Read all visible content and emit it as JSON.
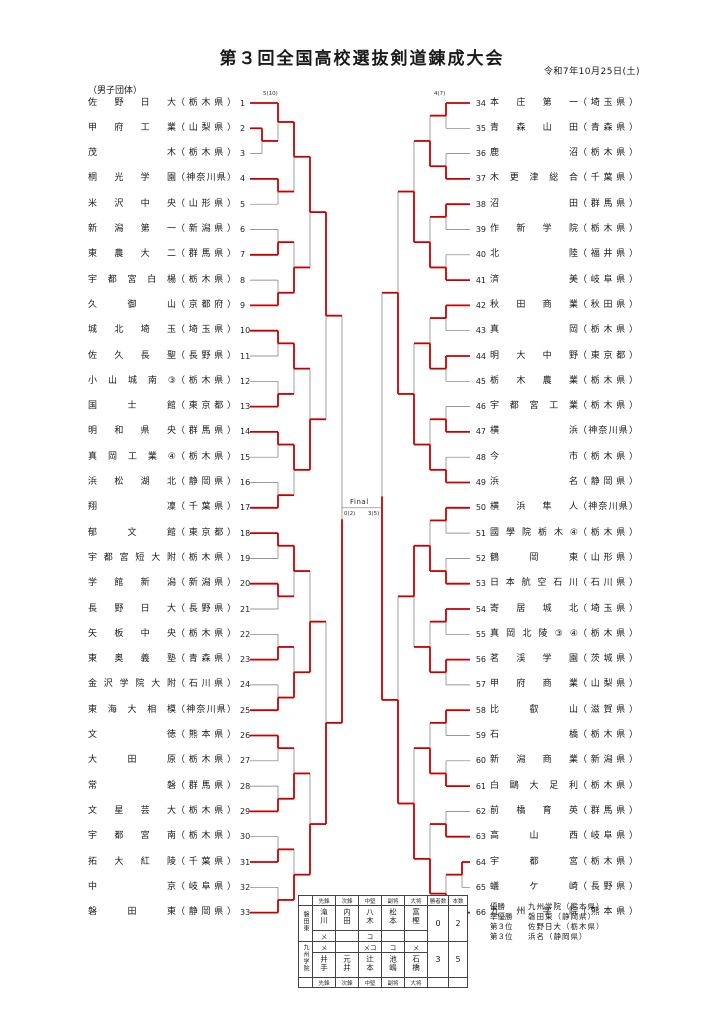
{
  "page": {
    "title": "第３回全国高校選抜剣道錬成大会",
    "date": "令和7年10月25日(土)",
    "category": "（男子団体）"
  },
  "teams": [
    {
      "n": 1,
      "name": "佐野日大",
      "pref": "栃木県"
    },
    {
      "n": 2,
      "name": "甲府工業",
      "pref": "山梨県"
    },
    {
      "n": 3,
      "name": "茂木",
      "pref": "栃木県"
    },
    {
      "n": 4,
      "name": "桐光学園",
      "pref": "神奈川県"
    },
    {
      "n": 5,
      "name": "米沢中央",
      "pref": "山形県"
    },
    {
      "n": 6,
      "name": "新潟第一",
      "pref": "新潟県"
    },
    {
      "n": 7,
      "name": "東農大二",
      "pref": "群馬県"
    },
    {
      "n": 8,
      "name": "宇都宮白楊",
      "pref": "栃木県"
    },
    {
      "n": 9,
      "name": "久御山",
      "pref": "京都府"
    },
    {
      "n": 10,
      "name": "城北埼玉",
      "pref": "埼玉県"
    },
    {
      "n": 11,
      "name": "佐久長聖",
      "pref": "長野県"
    },
    {
      "n": 12,
      "name": "小山城南",
      "mark": "③",
      "pref": "栃木県"
    },
    {
      "n": 13,
      "name": "国士館",
      "pref": "東京都"
    },
    {
      "n": 14,
      "name": "明和県央",
      "pref": "群馬県"
    },
    {
      "n": 15,
      "name": "真岡工業",
      "mark": "④",
      "pref": "栃木県"
    },
    {
      "n": 16,
      "name": "浜松湖北",
      "pref": "静岡県"
    },
    {
      "n": 17,
      "name": "翔凜",
      "pref": "千葉県"
    },
    {
      "n": 18,
      "name": "郁文館",
      "pref": "東京都"
    },
    {
      "n": 19,
      "name": "宇都宮短大附",
      "pref": "栃木県"
    },
    {
      "n": 20,
      "name": "学館新潟",
      "pref": "新潟県"
    },
    {
      "n": 21,
      "name": "長野日大",
      "pref": "長野県"
    },
    {
      "n": 22,
      "name": "矢板中央",
      "pref": "栃木県"
    },
    {
      "n": 23,
      "name": "東奥義塾",
      "pref": "青森県"
    },
    {
      "n": 24,
      "name": "金沢学院大附",
      "pref": "石川県"
    },
    {
      "n": 25,
      "name": "東海大相模",
      "pref": "神奈川県"
    },
    {
      "n": 26,
      "name": "文徳",
      "pref": "熊本県"
    },
    {
      "n": 27,
      "name": "大田原",
      "pref": "栃木県"
    },
    {
      "n": 28,
      "name": "常磐",
      "pref": "群馬県"
    },
    {
      "n": 29,
      "name": "文星芸大",
      "pref": "栃木県"
    },
    {
      "n": 30,
      "name": "宇都宮南",
      "pref": "栃木県"
    },
    {
      "n": 31,
      "name": "拓大紅陵",
      "pref": "千葉県"
    },
    {
      "n": 32,
      "name": "中京",
      "pref": "岐阜県"
    },
    {
      "n": 33,
      "name": "磐田東",
      "pref": "静岡県"
    },
    {
      "n": 34,
      "name": "本庄第一",
      "pref": "埼玉県"
    },
    {
      "n": 35,
      "name": "青森山田",
      "pref": "青森県"
    },
    {
      "n": 36,
      "name": "鹿沼",
      "pref": "栃木県"
    },
    {
      "n": 37,
      "name": "木更津総合",
      "pref": "千葉県"
    },
    {
      "n": 38,
      "name": "沼田",
      "pref": "群馬県"
    },
    {
      "n": 39,
      "name": "作新学院",
      "pref": "栃木県"
    },
    {
      "n": 40,
      "name": "北陸",
      "pref": "福井県"
    },
    {
      "n": 41,
      "name": "済美",
      "pref": "岐阜県"
    },
    {
      "n": 42,
      "name": "秋田商業",
      "pref": "秋田県"
    },
    {
      "n": 43,
      "name": "真岡",
      "pref": "栃木県"
    },
    {
      "n": 44,
      "name": "明大中野",
      "pref": "東京都"
    },
    {
      "n": 45,
      "name": "栃木農業",
      "pref": "栃木県"
    },
    {
      "n": 46,
      "name": "宇都宮工業",
      "pref": "栃木県"
    },
    {
      "n": 47,
      "name": "横浜",
      "pref": "神奈川県"
    },
    {
      "n": 48,
      "name": "今市",
      "pref": "栃木県"
    },
    {
      "n": 49,
      "name": "浜名",
      "pref": "静岡県"
    },
    {
      "n": 50,
      "name": "横浜隼人",
      "pref": "神奈川県"
    },
    {
      "n": 51,
      "name": "國學院栃木",
      "mark": "④",
      "pref": "栃木県"
    },
    {
      "n": 52,
      "name": "鶴岡東",
      "pref": "山形県"
    },
    {
      "n": 53,
      "name": "日本航空石川",
      "pref": "石川県"
    },
    {
      "n": 54,
      "name": "寄居城北",
      "pref": "埼玉県"
    },
    {
      "n": 55,
      "name": "真岡北陵",
      "mark": "③④",
      "pref": "栃木県"
    },
    {
      "n": 56,
      "name": "茗渓学園",
      "pref": "茨城県"
    },
    {
      "n": 57,
      "name": "甲府商業",
      "pref": "山梨県"
    },
    {
      "n": 58,
      "name": "比叡山",
      "pref": "滋賀県"
    },
    {
      "n": 59,
      "name": "石橋",
      "pref": "栃木県"
    },
    {
      "n": 60,
      "name": "新潟商業",
      "pref": "新潟県"
    },
    {
      "n": 61,
      "name": "白鷗大足利",
      "pref": "栃木県"
    },
    {
      "n": 62,
      "name": "前橋育英",
      "pref": "群馬県"
    },
    {
      "n": 63,
      "name": "高山西",
      "pref": "岐阜県"
    },
    {
      "n": 64,
      "name": "宇都宮",
      "pref": "栃木県"
    },
    {
      "n": 65,
      "name": "蟻ケ崎",
      "pref": "長野県"
    },
    {
      "n": 66,
      "name": "九州学院",
      "pref": "熊本県"
    }
  ],
  "bracket": {
    "colors": {
      "win": "#c40000",
      "line": "#777777"
    },
    "final_label": "Final",
    "final_left_score": "0(2)",
    "final_right_score": "3(5)",
    "score_labels": [
      {
        "team": 1,
        "text": "5(10)"
      },
      {
        "team": 34,
        "text": "4(7)"
      }
    ],
    "left": {
      "playin": {
        "a": 2,
        "b": 3,
        "winner": 2
      },
      "slots": [
        [
          1,
          0
        ],
        [
          4,
          5
        ],
        [
          6,
          7
        ],
        [
          8,
          9
        ],
        [
          10,
          11
        ],
        [
          12,
          13
        ],
        [
          14,
          15
        ],
        [
          16,
          17
        ],
        [
          18,
          19
        ],
        [
          20,
          21
        ],
        [
          22,
          23
        ],
        [
          24,
          25
        ],
        [
          26,
          27
        ],
        [
          28,
          29
        ],
        [
          30,
          31
        ],
        [
          32,
          33
        ]
      ],
      "winners": [
        [
          1,
          4,
          7,
          9,
          10,
          13,
          14,
          17,
          18,
          20,
          23,
          25,
          26,
          29,
          31,
          33
        ],
        [
          1,
          9,
          10,
          14,
          18,
          25,
          29,
          33
        ],
        [
          1,
          14,
          25,
          33
        ],
        [
          1,
          33
        ],
        [
          33
        ]
      ]
    },
    "right": {
      "playin": {
        "a": 64,
        "b": 65,
        "winner": 64
      },
      "slots": [
        [
          34,
          35
        ],
        [
          36,
          37
        ],
        [
          38,
          39
        ],
        [
          40,
          41
        ],
        [
          42,
          43
        ],
        [
          44,
          45
        ],
        [
          46,
          47
        ],
        [
          48,
          49
        ],
        [
          50,
          51
        ],
        [
          52,
          53
        ],
        [
          54,
          55
        ],
        [
          56,
          57
        ],
        [
          58,
          59
        ],
        [
          60,
          61
        ],
        [
          62,
          63
        ],
        [
          0,
          66
        ]
      ],
      "winners": [
        [
          34,
          37,
          38,
          41,
          42,
          44,
          47,
          49,
          50,
          53,
          54,
          56,
          58,
          61,
          63,
          66
        ],
        [
          37,
          41,
          44,
          49,
          53,
          56,
          61,
          66
        ],
        [
          41,
          49,
          53,
          66
        ],
        [
          49,
          66
        ],
        [
          66
        ]
      ]
    }
  },
  "final_table": {
    "position_headers": [
      "先鋒",
      "次鋒",
      "中堅",
      "副将",
      "大将"
    ],
    "wins_header": "勝者数",
    "points_header": "本数",
    "teams": [
      {
        "label": "磐田東",
        "players": [
          "滝川",
          "内田",
          "八木",
          "松本",
          "富樫"
        ],
        "ippon": [
          "メ",
          "",
          "コ",
          "",
          ""
        ],
        "wins": "0",
        "points": "2"
      },
      {
        "label": "九州学院",
        "players": [
          "井手",
          "元井",
          "辻本",
          "池嶋",
          "石橋"
        ],
        "ippon": [
          "メ",
          "",
          "メコ",
          "コ",
          "メ"
        ],
        "wins": "3",
        "points": "5"
      }
    ]
  },
  "results": {
    "rows": [
      {
        "rank": "優勝",
        "team": "九州学院",
        "pref": "（熊本県）"
      },
      {
        "rank": "準優勝",
        "team": "磐田東",
        "pref": "（静岡県）"
      },
      {
        "rank": "第３位",
        "team": "佐野日大",
        "pref": "（栃木県）"
      },
      {
        "rank": "第３位",
        "team": "浜名",
        "pref": "（静岡県）"
      }
    ]
  }
}
